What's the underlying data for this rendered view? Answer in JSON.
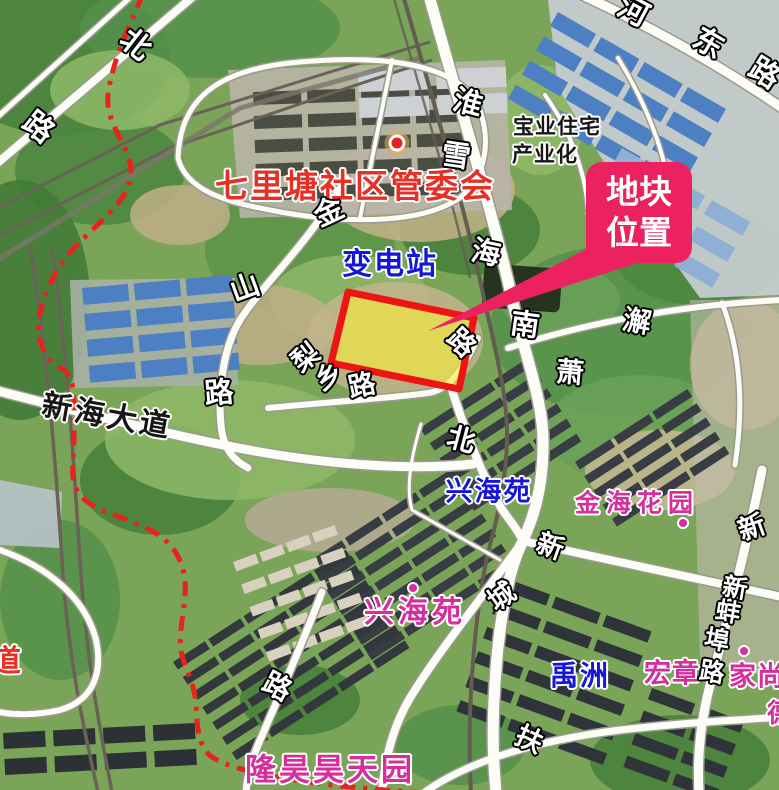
{
  "map": {
    "width": 779,
    "height": 790,
    "colors": {
      "boundary_red": "#e7231c",
      "parcel_fill": "#f8ee3c",
      "parcel_fill_opacity": 0.62,
      "parcel_stroke": "#ee1414",
      "callout_pink": "#ec2160",
      "road_fill": "#fdfdf8",
      "road_casing": "#9a9a8e"
    },
    "callout": {
      "line1": "地块",
      "line2": "位置"
    },
    "poi_labels": [
      {
        "name": "qilitang-committee-label",
        "text": "七里塘社区管委会",
        "x": 355,
        "y": 186,
        "size": 33,
        "cls": "red",
        "rot": 0,
        "ls": 2
      },
      {
        "name": "jiedao-label",
        "text": "街道",
        "x": -9,
        "y": 662,
        "size": 30,
        "cls": "red",
        "rot": 0,
        "ls": 2
      },
      {
        "name": "substation-label",
        "text": "变电站",
        "x": 390,
        "y": 265,
        "size": 30,
        "cls": "blue",
        "rot": 0,
        "ls": 2
      },
      {
        "name": "xinghaiyuan-north-label",
        "text": "兴海苑",
        "x": 489,
        "y": 492,
        "size": 27,
        "cls": "blue",
        "rot": 0,
        "ls": 2
      },
      {
        "name": "yuzhou-label",
        "text": "禹洲",
        "x": 580,
        "y": 676,
        "size": 28,
        "cls": "blue",
        "rot": 0,
        "ls": 2
      },
      {
        "name": "baoye-housing-label-line1",
        "text": "宝业住宅",
        "x": 557,
        "y": 127,
        "size": 21,
        "cls": "blk",
        "rot": 0,
        "ls": 1
      },
      {
        "name": "baoye-housing-label-line2",
        "text": "产业化",
        "x": 545,
        "y": 155,
        "size": 21,
        "cls": "blk",
        "rot": 0,
        "ls": 1
      },
      {
        "name": "xinhai-avenue-label",
        "text": "新海大道",
        "x": 107,
        "y": 417,
        "size": 30,
        "cls": "blk",
        "rot": 10,
        "ls": 3
      },
      {
        "name": "jinhai-garden-label",
        "text": "金海花园",
        "x": 637,
        "y": 503,
        "size": 25,
        "cls": "mag",
        "rot": 0,
        "ls": 6
      },
      {
        "name": "xinghaiyuan-south-label",
        "text": "兴海苑",
        "x": 415,
        "y": 613,
        "size": 30,
        "cls": "mag",
        "rot": 0,
        "ls": 4
      },
      {
        "name": "longhao-haotianyuan-label",
        "text": "隆昊昊天园",
        "x": 330,
        "y": 771,
        "size": 31,
        "cls": "mag",
        "rot": 0,
        "ls": 3
      },
      {
        "name": "hongzhang-label",
        "text": "宏章",
        "x": 672,
        "y": 674,
        "size": 27,
        "cls": "mag",
        "rot": 0,
        "ls": 1
      },
      {
        "name": "jiashang-label",
        "text": "家尚",
        "x": 757,
        "y": 677,
        "size": 27,
        "cls": "mag",
        "rot": 0,
        "ls": 1
      },
      {
        "name": "partial-label-right-edge",
        "text": "德",
        "x": 780,
        "y": 714,
        "size": 26,
        "cls": "mag",
        "rot": 0,
        "ls": 0
      }
    ],
    "road_labels": [
      {
        "text": "北",
        "x": 135,
        "y": 45,
        "rot": 38,
        "size": 30
      },
      {
        "text": "路",
        "x": 38,
        "y": 128,
        "rot": 38,
        "size": 30
      },
      {
        "text": "淮",
        "x": 468,
        "y": 103,
        "rot": 15,
        "size": 29
      },
      {
        "text": "雪",
        "x": 456,
        "y": 156,
        "rot": 8,
        "size": 29
      },
      {
        "text": "海",
        "x": 486,
        "y": 253,
        "rot": 12,
        "size": 29
      },
      {
        "text": "南",
        "x": 525,
        "y": 325,
        "rot": 8,
        "size": 29
      },
      {
        "text": "金",
        "x": 329,
        "y": 212,
        "rot": -25,
        "size": 29
      },
      {
        "text": "山",
        "x": 245,
        "y": 288,
        "rot": -20,
        "size": 29
      },
      {
        "text": "路",
        "x": 219,
        "y": 393,
        "rot": -5,
        "size": 29
      },
      {
        "text": "梨",
        "x": 306,
        "y": 358,
        "rot": -38,
        "size": 27
      },
      {
        "text": "乡",
        "x": 329,
        "y": 377,
        "rot": -30,
        "size": 27
      },
      {
        "text": "路",
        "x": 362,
        "y": 386,
        "rot": -12,
        "size": 27
      },
      {
        "text": "路",
        "x": 461,
        "y": 343,
        "rot": 45,
        "size": 27
      },
      {
        "text": "北",
        "x": 461,
        "y": 440,
        "rot": 15,
        "size": 28
      },
      {
        "text": "澥",
        "x": 637,
        "y": 322,
        "rot": 10,
        "size": 28
      },
      {
        "text": "萧",
        "x": 570,
        "y": 373,
        "rot": 5,
        "size": 28
      },
      {
        "text": "河",
        "x": 633,
        "y": 12,
        "rot": 28,
        "size": 30
      },
      {
        "text": "东",
        "x": 708,
        "y": 44,
        "rot": 30,
        "size": 30
      },
      {
        "text": "路",
        "x": 764,
        "y": 74,
        "rot": 32,
        "size": 30
      },
      {
        "text": "新",
        "x": 550,
        "y": 547,
        "rot": 20,
        "size": 27
      },
      {
        "text": "城",
        "x": 502,
        "y": 597,
        "rot": -35,
        "size": 27
      },
      {
        "text": "扶",
        "x": 529,
        "y": 740,
        "rot": 25,
        "size": 27
      },
      {
        "text": "新",
        "x": 752,
        "y": 528,
        "rot": -20,
        "size": 27
      },
      {
        "text": "新",
        "x": 735,
        "y": 588,
        "rot": 10,
        "size": 25
      },
      {
        "text": "蚌",
        "x": 728,
        "y": 612,
        "rot": 10,
        "size": 25
      },
      {
        "text": "埠",
        "x": 717,
        "y": 640,
        "rot": 10,
        "size": 25
      },
      {
        "text": "路",
        "x": 712,
        "y": 672,
        "rot": 10,
        "size": 25
      },
      {
        "text": "路",
        "x": 277,
        "y": 687,
        "rot": 28,
        "size": 28
      }
    ],
    "markers": [
      {
        "name": "committee-marker",
        "x": 397,
        "y": 143,
        "type": "ring-dot"
      },
      {
        "name": "xinghaiyuan-marker",
        "x": 413,
        "y": 588,
        "type": "dot"
      },
      {
        "name": "jinhai-marker",
        "x": 683,
        "y": 523,
        "type": "dot"
      },
      {
        "name": "hongzhang-marker",
        "x": 744,
        "y": 651,
        "type": "dot"
      }
    ]
  }
}
